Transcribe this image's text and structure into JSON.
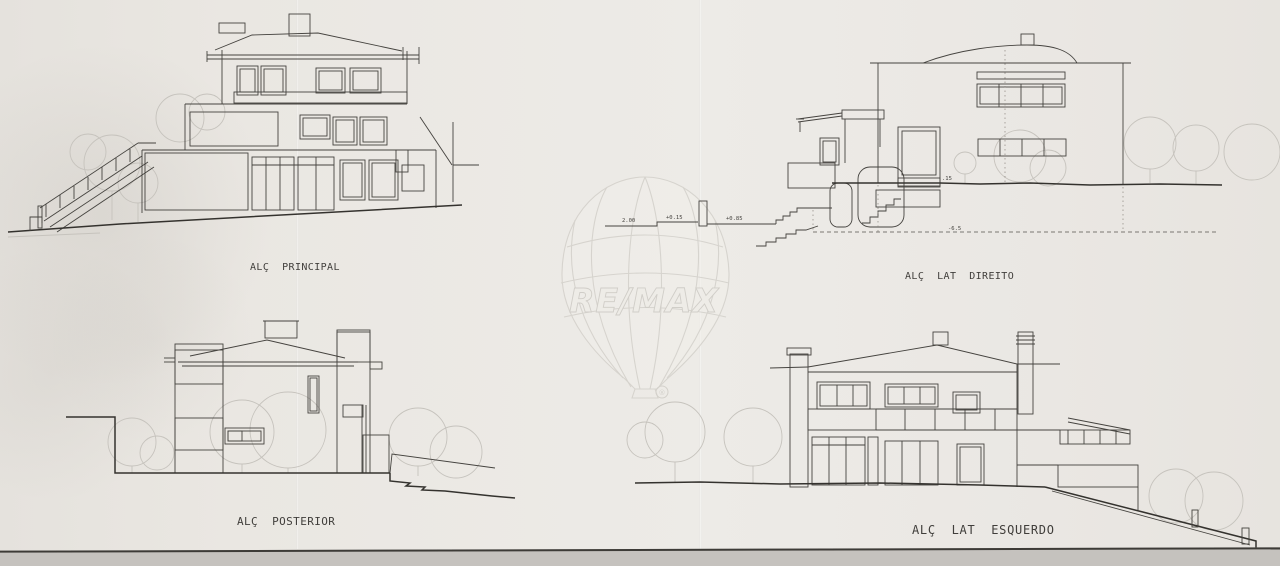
{
  "sheet": {
    "labels": {
      "principal": "ALÇ  PRINCIPAL",
      "lat_direito": "ALÇ  LAT  DIREITO",
      "posterior": "ALÇ  POSTERIOR",
      "lat_esquerdo": "ALÇ  LAT  ESQUERDO"
    },
    "annotations": {
      "dim_200": "2.00",
      "dim_015": "+0.15",
      "dim_085": "+0.85",
      "dim_15": ".15",
      "dim_65": "-6.5"
    },
    "watermark": {
      "brand": "RE/MAX",
      "registered": "®"
    },
    "colors": {
      "paper": "#eae7e2",
      "ink": "#45433f",
      "ink_bold": "#34322e",
      "faint_trees": "#c6c3bd",
      "watermark": "#d3d0ca",
      "scan_edge": "#c5c2be"
    }
  }
}
